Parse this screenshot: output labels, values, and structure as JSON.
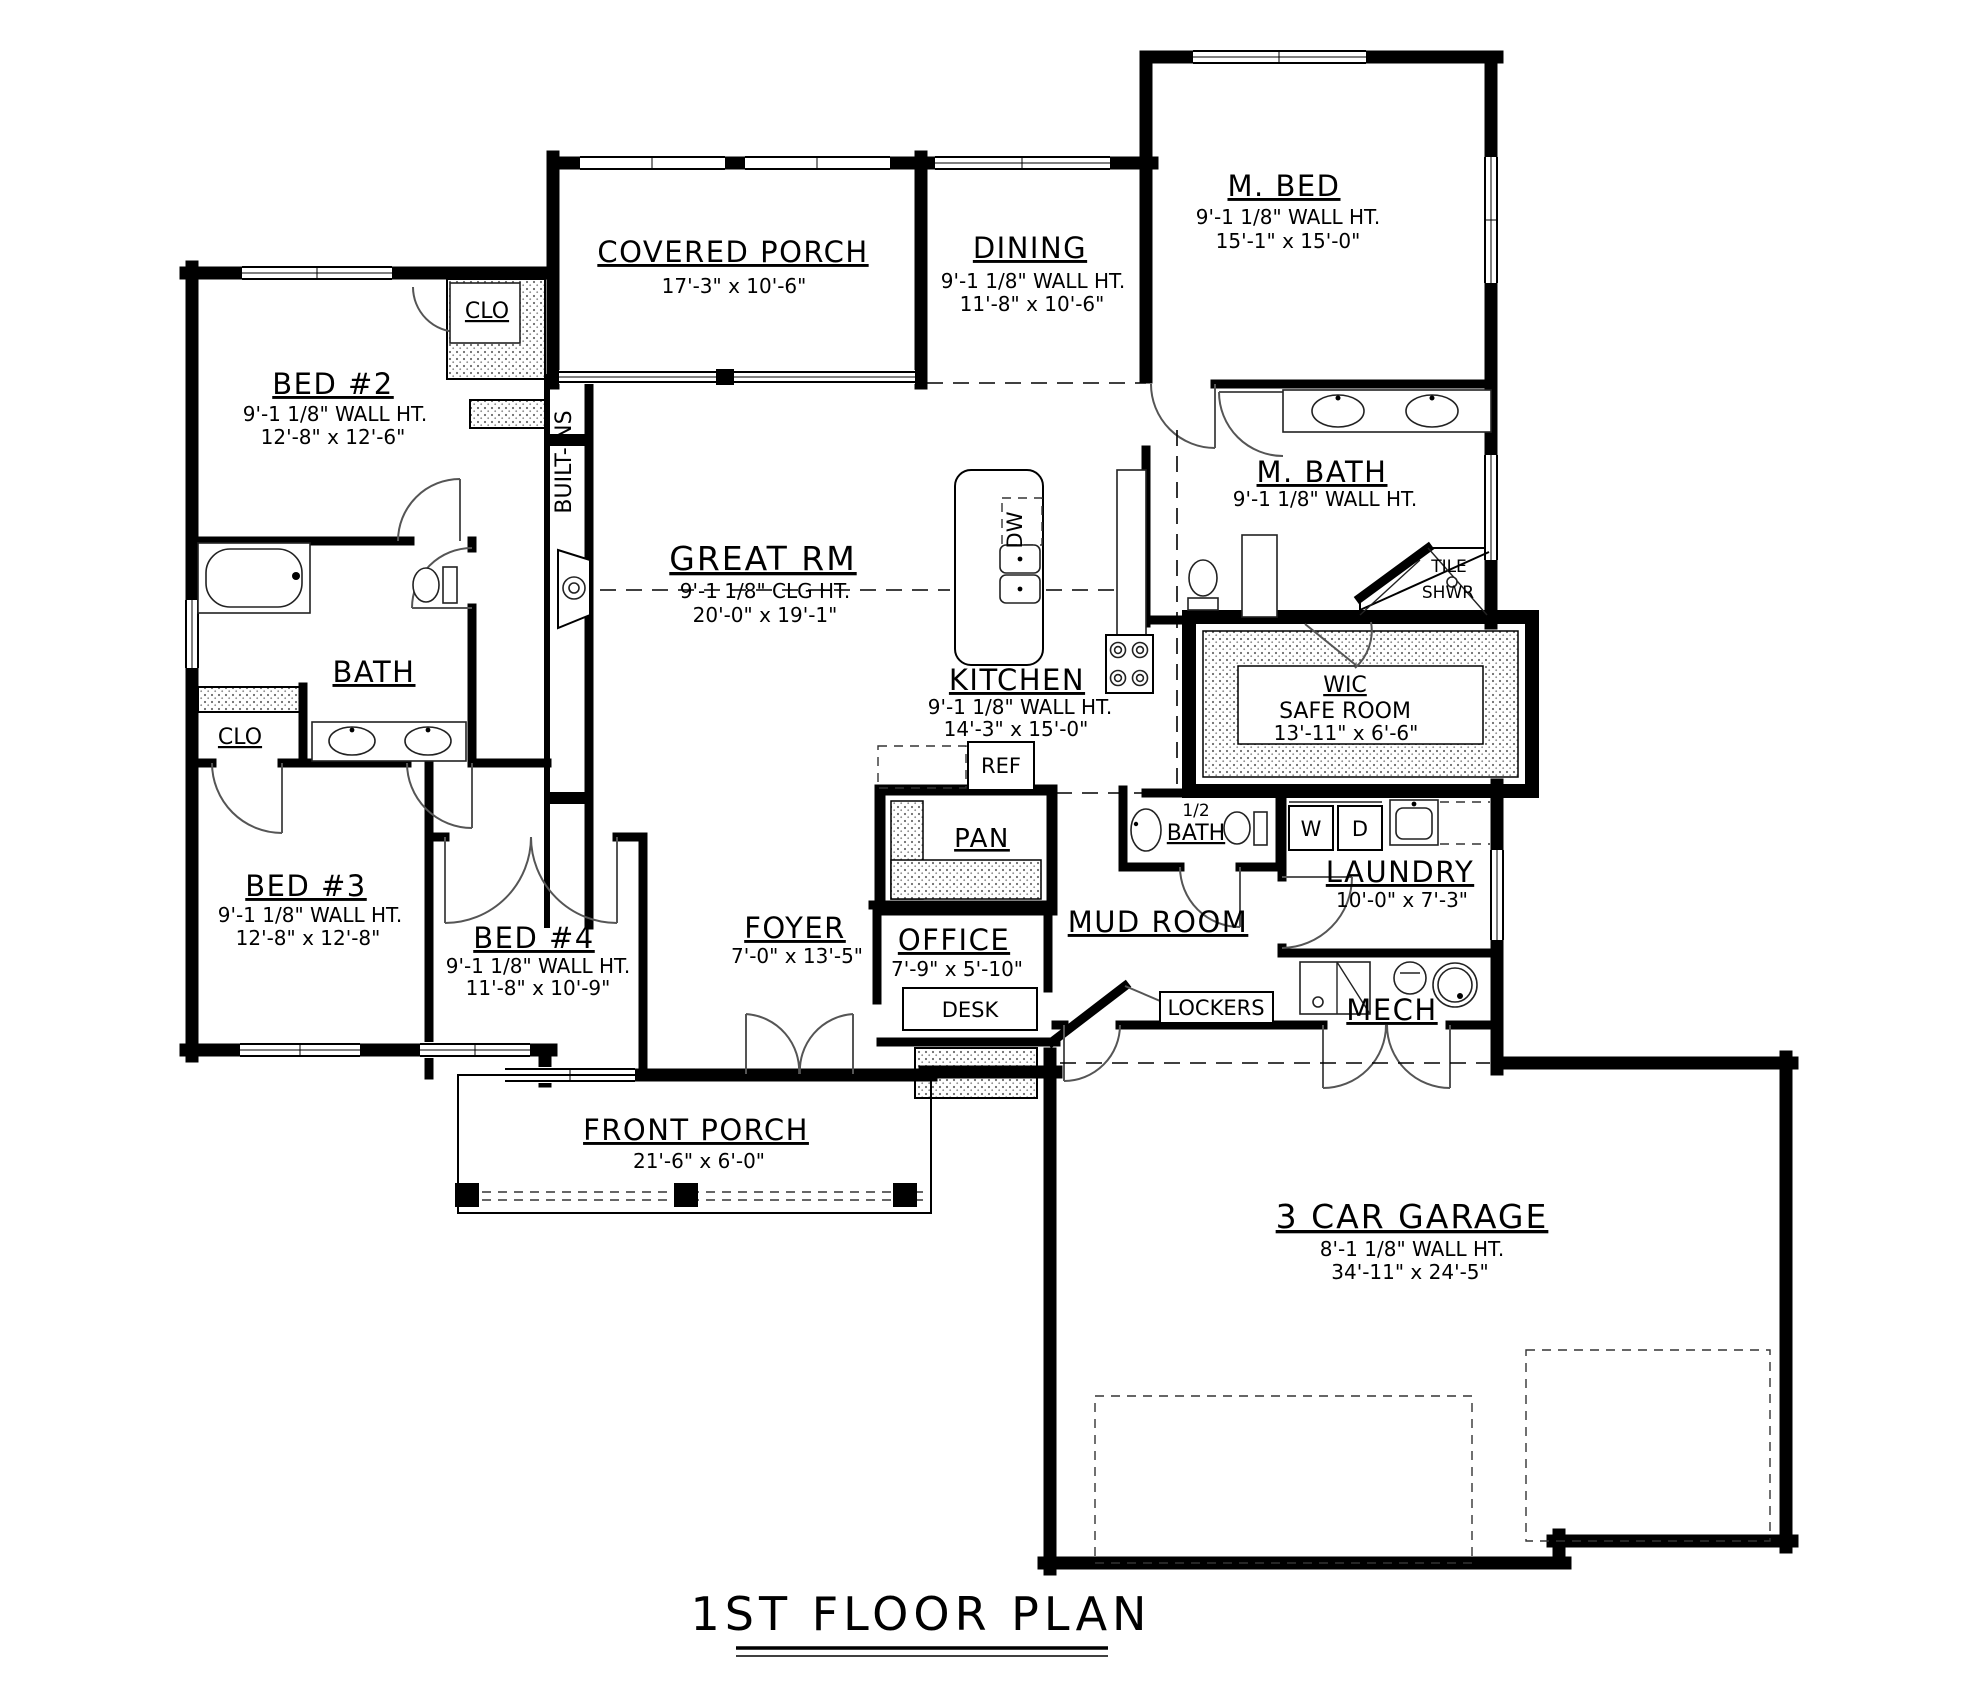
{
  "title": {
    "text": "1ST FLOOR PLAN"
  },
  "rooms": {
    "covered_porch": {
      "name": "COVERED PORCH",
      "dim": "17'-3\" x 10'-6\""
    },
    "m_bed": {
      "name": "M. BED",
      "ht": "9'-1 1/8\" WALL HT.",
      "dim": "15'-1\" x 15'-0\""
    },
    "dining": {
      "name": "DINING",
      "ht": "9'-1 1/8\" WALL HT.",
      "dim": "11'-8\" x 10'-6\""
    },
    "bed2": {
      "name": "BED #2",
      "ht": "9'-1 1/8\" WALL HT.",
      "dim": "12'-8\" x 12'-6\""
    },
    "bed2_clo": {
      "name": "CLO"
    },
    "built_ins": {
      "name": "BUILT-INS"
    },
    "great_rm": {
      "name": "GREAT RM",
      "ht": "9'-1 1/8\" CLG HT.",
      "dim": "20'-0\" x 19'-1\""
    },
    "m_bath": {
      "name": "M. BATH",
      "ht": "9'-1 1/8\" WALL HT."
    },
    "tile_shwr": {
      "line1": "TILE",
      "line2": "SHWR"
    },
    "bath": {
      "name": "BATH"
    },
    "hall_clo": {
      "name": "CLO"
    },
    "kitchen": {
      "name": "KITCHEN",
      "ht": "9'-1 1/8\" WALL HT.",
      "dim": "14'-3\" x 15'-0\""
    },
    "wic": {
      "name": "WIC",
      "name2": "SAFE ROOM",
      "dim": "13'-11\" x 6'-6\""
    },
    "bed3": {
      "name": "BED #3",
      "ht": "9'-1 1/8\" WALL HT.",
      "dim": "12'-8\" x 12'-8\""
    },
    "bed4": {
      "name": "BED #4",
      "ht": "9'-1 1/8\" WALL HT.",
      "dim": "11'-8\" x 10'-9\""
    },
    "foyer": {
      "name": "FOYER",
      "dim": "7'-0\" x 13'-5\""
    },
    "office": {
      "name": "OFFICE",
      "dim": "7'-9\" x 5'-10\""
    },
    "mud_room": {
      "name": "MUD ROOM"
    },
    "half_bath": {
      "line1": "1/2",
      "line2": "BATH"
    },
    "laundry": {
      "name": "LAUNDRY",
      "dim": "10'-0\" x 7'-3\""
    },
    "mech": {
      "name": "MECH"
    },
    "front_porch": {
      "name": "FRONT PORCH",
      "dim": "21'-6\" x 6'-0\""
    },
    "garage": {
      "name": "3 CAR GARAGE",
      "ht": "8'-1 1/8\" WALL HT.",
      "dim": "34'-11\" x 24'-5\""
    }
  },
  "labels": {
    "dw": "DW",
    "ref": "REF",
    "pan": "PAN",
    "desk": "DESK",
    "lockers": "LOCKERS",
    "washer": "W",
    "dryer": "D"
  },
  "colors": {
    "ink": "#000000",
    "paper": "#ffffff"
  }
}
